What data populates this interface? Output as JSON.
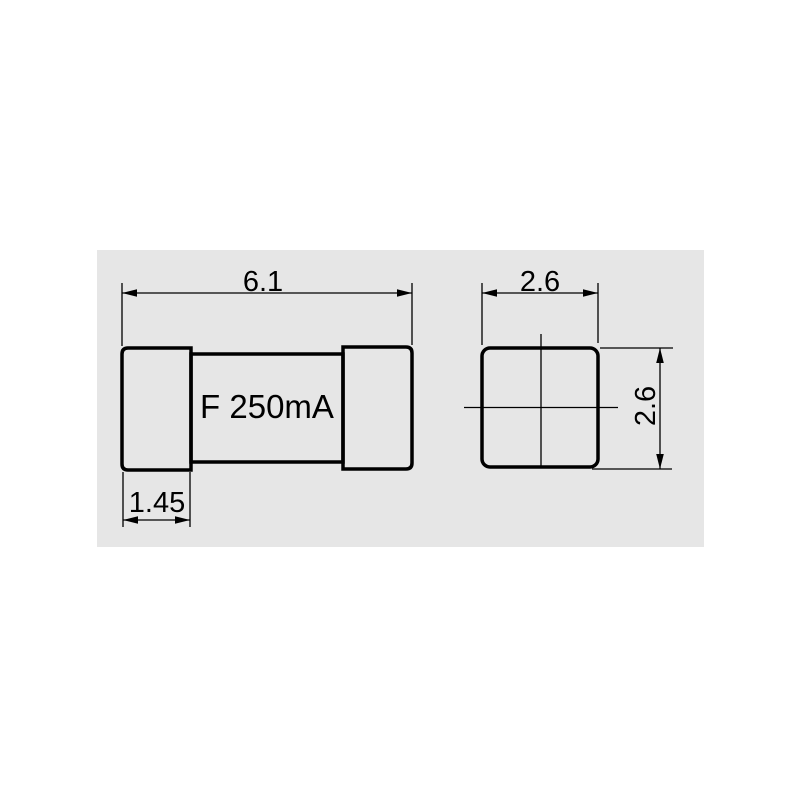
{
  "colors": {
    "page_background": "#ffffff",
    "panel_background": "#e6e6e6",
    "line": "#000000",
    "text": "#000000"
  },
  "drawing": {
    "part_label": "F 250mA",
    "side_view": {
      "overall_length": "6.1",
      "cap_length": "1.45"
    },
    "end_view": {
      "width": "2.6",
      "height": "2.6"
    }
  }
}
